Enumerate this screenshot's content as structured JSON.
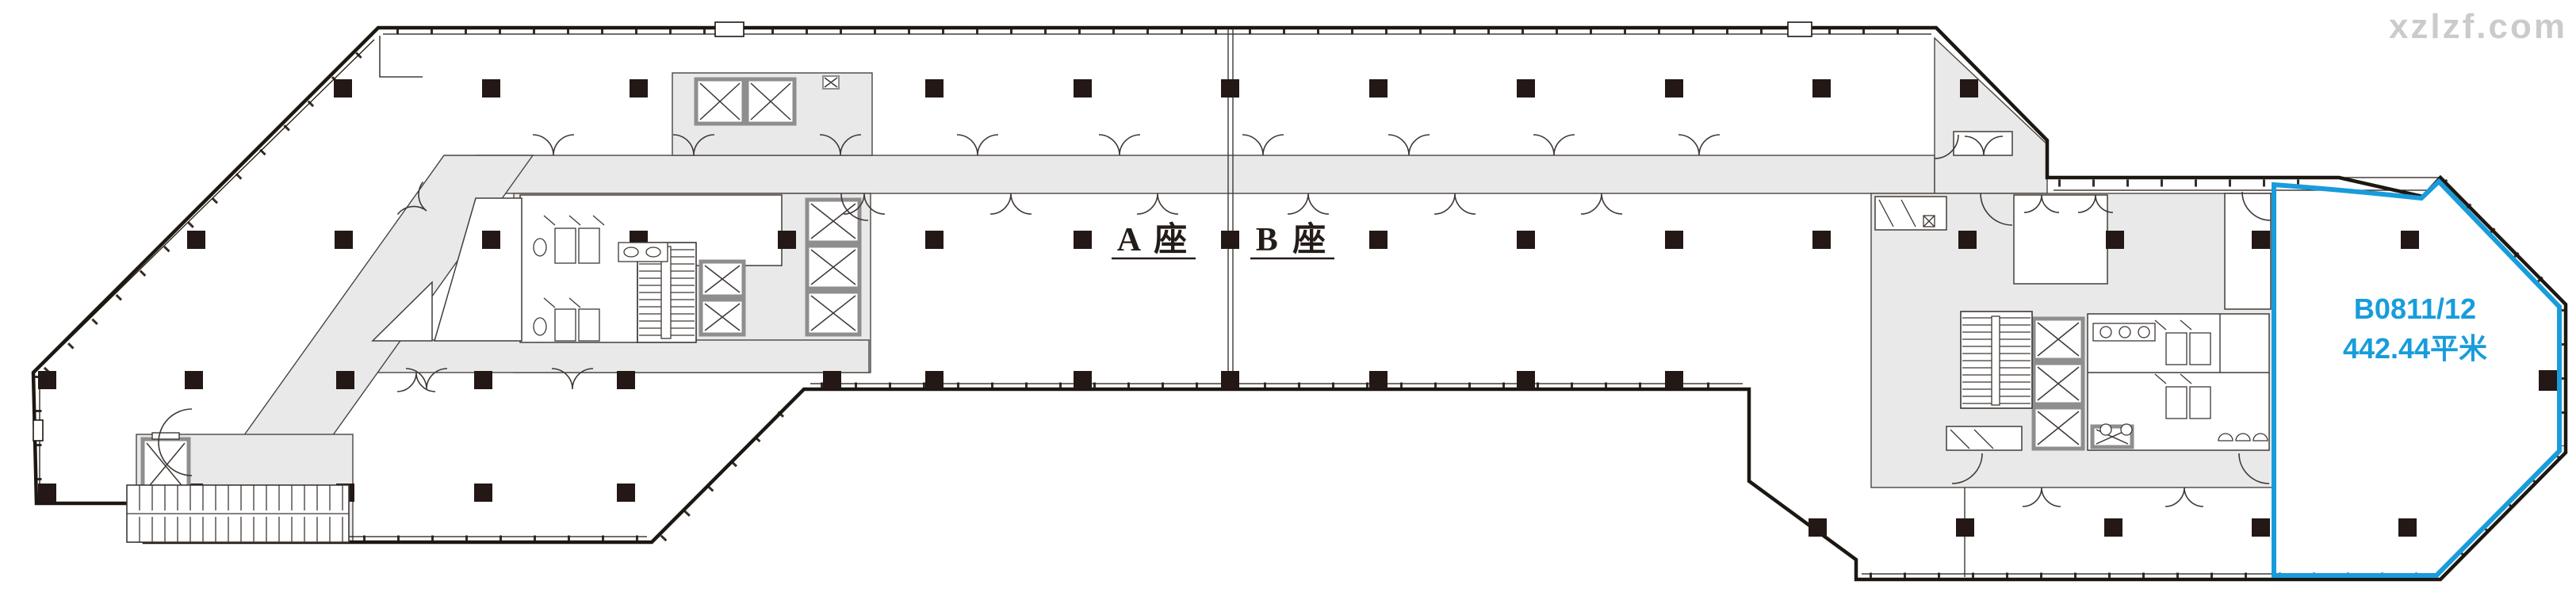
{
  "watermark": {
    "text": "xzlzf.com",
    "color": "#c9c9c9"
  },
  "blocks": {
    "a_label": "A 座",
    "b_label": "B 座",
    "label_color": "#241c18"
  },
  "unit": {
    "id": "B0811/12",
    "area": "442.44平米",
    "accent_color": "#189cdb"
  },
  "colors": {
    "wall": "#221a16",
    "zone_fill": "#e9e9e9"
  }
}
